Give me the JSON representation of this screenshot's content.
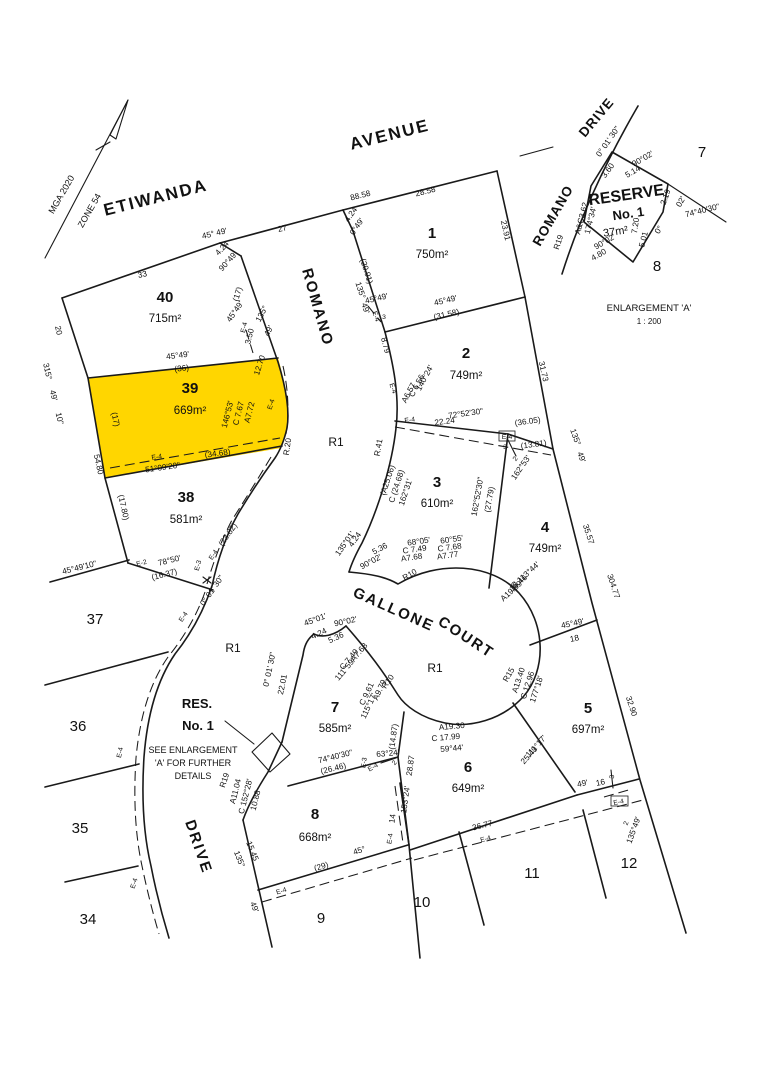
{
  "colors": {
    "highlight": "#FFD600",
    "line": "#1a1a1a"
  },
  "compass": {
    "l1": "MGA 2020",
    "l2": "ZONE 54"
  },
  "streets": {
    "etiwanda": "ETIWANDA",
    "avenue": "AVENUE",
    "romano_main": "ROMANO",
    "drive_main": "DRIVE",
    "gallone": "GALLONE",
    "court": "COURT",
    "romano_enl": "ROMANO",
    "drive_enl": "DRIVE"
  },
  "zones": [
    "R1",
    "R1",
    "R1"
  ],
  "res": {
    "t1": "RES.",
    "t2": "No. 1",
    "n1": "SEE ENLARGEMENT",
    "n2": "'A' FOR FURTHER",
    "n3": "DETAILS"
  },
  "enl": {
    "title": "ENLARGEMENT 'A'",
    "scale": "1 : 200",
    "reserve": "RESERVE",
    "no": "No. 1",
    "area": "37m²",
    "lot7": "7",
    "lot8": "8",
    "dims": [
      "0° 01' 30\"",
      "90°02'",
      "3.60",
      "5.14",
      "A&C3.62",
      "174°34'",
      "R19",
      "2.19",
      "02'",
      "74°40'30\"",
      "7.20",
      "5.01",
      "0°",
      "90°02'",
      "4.80"
    ]
  },
  "lots": [
    {
      "n": "40",
      "a": "715m²"
    },
    {
      "n": "39",
      "a": "669m²"
    },
    {
      "n": "38",
      "a": "581m²"
    },
    {
      "n": "37"
    },
    {
      "n": "36"
    },
    {
      "n": "35"
    },
    {
      "n": "34"
    },
    {
      "n": "1",
      "a": "750m²"
    },
    {
      "n": "2",
      "a": "749m²"
    },
    {
      "n": "3",
      "a": "610m²"
    },
    {
      "n": "4",
      "a": "749m²"
    },
    {
      "n": "5",
      "a": "697m²"
    },
    {
      "n": "6",
      "a": "649m²"
    },
    {
      "n": "7",
      "a": "585m²"
    },
    {
      "n": "8",
      "a": "668m²"
    },
    {
      "n": "9"
    },
    {
      "n": "10"
    },
    {
      "n": "11"
    },
    {
      "n": "12"
    }
  ],
  "dims": [
    "45°  49'",
    "33",
    "27",
    "4.24",
    "90°49'",
    "88.58",
    "28.58",
    "4.24",
    "0°49'",
    "23.91",
    "(20.91)",
    "135°",
    "49'",
    "45°49'",
    "E-4",
    "3",
    "45°49'",
    "(31.58)",
    "31.73",
    "8.79",
    "140°24'",
    "C 6.56",
    "A6.57",
    "E-4",
    "72°52'30\"",
    "22.24",
    "E-4",
    "(36.05)",
    "(13.81)",
    "E-4",
    "3",
    "2",
    "162°53'",
    "162°52'30\"",
    "(27.79)",
    "R.41",
    "(A25.06)",
    "C (24.68)",
    "162°31'",
    "135°01'",
    "4.24",
    "5.36",
    "90°02'",
    "R10",
    "68°05'",
    "C 7.49",
    "A7.68",
    "60°55'",
    "C 7.68",
    "A7.77",
    "135°",
    "49'",
    "35.57",
    "304.77",
    "C 113°44'",
    "18.46",
    "A19.89",
    "45°49'",
    "18",
    "R15",
    "A13.40",
    "C 12.96",
    "177°18'",
    "111°17'",
    "25.49",
    "32.90",
    "49'",
    "16",
    "3",
    "E-4",
    "2",
    "135°49'",
    "A19.30",
    "C 17.99",
    "59°44'",
    "(14.87)",
    "28.87",
    "63°24'",
    "2",
    "E-4",
    "153°24'",
    "14",
    "E-4",
    "36.77",
    "E-4",
    "45°01'",
    "90°02'",
    "4.24",
    "5.36",
    "A7.68",
    "C 7.49",
    "111°59'",
    "R10",
    "A9.79",
    "C 9.61",
    "115°17'",
    "22.01",
    "0° 01' 30\"",
    "0° 01' 30\"",
    "74°40'30\"",
    "(26.46)",
    "E-3",
    "R19",
    "A11.04",
    "C 152°28'",
    "10.88",
    "135°",
    "15.45",
    "49'",
    "(29)",
    "45°",
    "E-4",
    "E-4",
    "20",
    "315°",
    "49'",
    "10\"",
    "(17)",
    "54.80",
    "(17.80)",
    "45°49'10\"",
    "E-2",
    "78°50'",
    "(16.37)",
    "E-3",
    "E-4",
    "(23.82)",
    "E-4",
    "E-4",
    "45°49'",
    "(36)",
    "E-4",
    "51°09'20\"",
    "(34.68)",
    "A7.72",
    "C 7.67",
    "146°53'",
    "12.70",
    "E-4",
    "R.20",
    "45°49'",
    "E-4",
    "3.50",
    "135°",
    "49'",
    "(17)"
  ]
}
